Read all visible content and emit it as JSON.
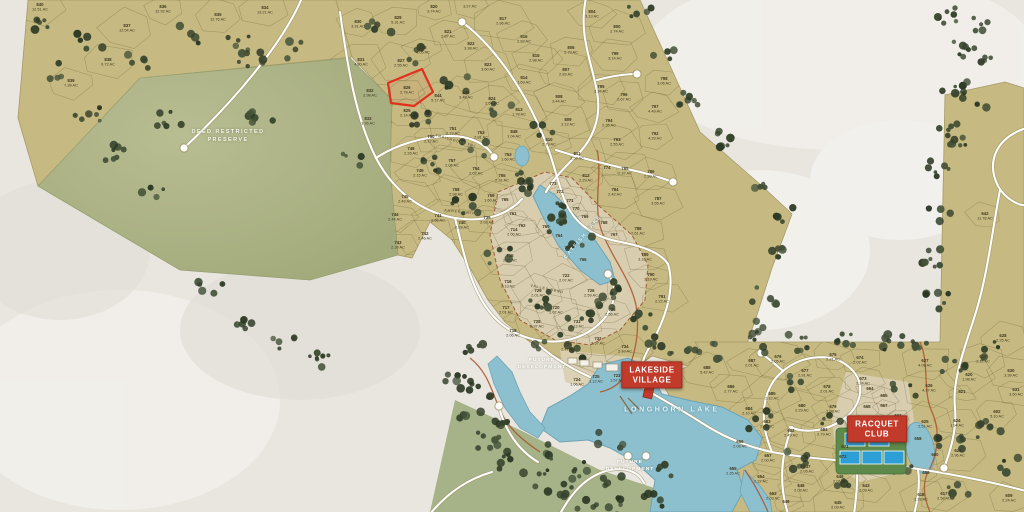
{
  "title": "Lakeside community plat map",
  "colors": {
    "background": "#e9e6e0",
    "land_tan": "#c6ba82",
    "preserve_green": "#a9b184",
    "village_beige": "#d9cfb1",
    "lake_blue": "#8cc0cf",
    "tree_green": "#36432c",
    "road_white": "#ffffff",
    "accent_red": "#c23a2a",
    "creek_orange": "#a8542c",
    "label_dark": "#3f381f"
  },
  "preserve_label": {
    "line1": "DEED RESTRICTED",
    "line2": "PRESERVE",
    "x": 228,
    "y": 136
  },
  "future_labels": [
    {
      "line1": "FUTURE",
      "line2": "DEVELOPMENT",
      "x": 542,
      "y": 364
    },
    {
      "line1": "FUTURE",
      "line2": "DEVELOPMENT",
      "x": 630,
      "y": 466
    }
  ],
  "lake_labels": [
    {
      "text": "LONGHORN LAKE",
      "x": 672,
      "y": 410
    },
    {
      "text": "CATFISH LAKE",
      "x": 583,
      "y": 237
    }
  ],
  "badges": [
    {
      "line1": "LAKESIDE",
      "line2": "VILLAGE",
      "x": 652,
      "y": 375
    },
    {
      "line1": "RACQUET",
      "line2": "CLUB",
      "x": 877,
      "y": 429
    }
  ],
  "road_labels": [
    {
      "text": "TRAILHOUSE TRL",
      "x": 456,
      "y": 141,
      "rot": 16
    },
    {
      "text": "AMBER DRIVE",
      "x": 461,
      "y": 212,
      "rot": 6
    },
    {
      "text": "VALLEY BEND",
      "x": 547,
      "y": 289,
      "rot": 12
    }
  ],
  "highlight": {
    "lot": "826",
    "area": "2.78 AC"
  },
  "lots": [
    [
      "840",
      "12.51 AC",
      40,
      6
    ],
    [
      "837",
      "12.54 AC",
      127,
      27
    ],
    [
      "836",
      "12.92 AC",
      163,
      8
    ],
    [
      "835",
      "12.76 AC",
      218,
      16
    ],
    [
      "834",
      "13.21 AC",
      265,
      9
    ],
    [
      "838",
      "9.72 AC",
      108,
      61
    ],
    [
      "839",
      "7.39 AC",
      71,
      82
    ],
    [
      "830",
      "3.31 AC",
      358,
      23
    ],
    [
      "829",
      "5.31 AC",
      398,
      19
    ],
    [
      "820",
      "3.74 AC",
      434,
      8
    ],
    [
      "",
      "3.27 AC",
      470,
      3
    ],
    [
      "828",
      "4.05 AC",
      423,
      49
    ],
    [
      "821",
      "2.87 AC",
      448,
      33
    ],
    [
      "817",
      "2.96 AC",
      503,
      20
    ],
    [
      "822",
      "3.38 AC",
      471,
      45
    ],
    [
      "816",
      "2.83 AC",
      524,
      38
    ],
    [
      "831",
      "4.80 AC",
      361,
      61
    ],
    [
      "827",
      "2.55 AC",
      401,
      62
    ],
    [
      "823",
      "3.60 AC",
      488,
      66
    ],
    [
      "815",
      "2.98 AC",
      536,
      57
    ],
    [
      "832",
      "2.98 AC",
      370,
      92
    ],
    [
      "826",
      "2.78 AC",
      407,
      89
    ],
    [
      "844",
      "5.17 AC",
      438,
      97
    ],
    [
      "845",
      "3.48 AC",
      466,
      94
    ],
    [
      "824",
      "2.54 AC",
      492,
      100
    ],
    [
      "814",
      "1.69 AC",
      524,
      79
    ],
    [
      "825",
      "2.14 AC",
      407,
      112
    ],
    [
      "813",
      "1.78 AC",
      519,
      111
    ],
    [
      "833",
      "3.26 AC",
      368,
      120
    ],
    [
      "804",
      "3.13 AC",
      592,
      13
    ],
    [
      "800",
      "2.74 AC",
      617,
      28
    ],
    [
      "806",
      "2.79 AC",
      571,
      49
    ],
    [
      "799",
      "3.14 AC",
      615,
      55
    ],
    [
      "807",
      "2.83 AC",
      566,
      71
    ],
    [
      "795",
      "2.34 AC",
      601,
      88
    ],
    [
      "796",
      "2.67 AC",
      624,
      96
    ],
    [
      "808",
      "3.44 AC",
      559,
      98
    ],
    [
      "809",
      "3.12 AC",
      568,
      121
    ],
    [
      "794",
      "2.35 AC",
      609,
      122
    ],
    [
      "798",
      "3.06 AC",
      664,
      80
    ],
    [
      "797",
      "4.49 AC",
      655,
      108
    ],
    [
      "748",
      "2.26 AC",
      411,
      150
    ],
    [
      "750",
      "2.12 AC",
      431,
      138
    ],
    [
      "751",
      "2.19 AC",
      453,
      130
    ],
    [
      "752",
      "2.91 AC",
      481,
      134
    ],
    [
      "848",
      "1.04 AC",
      514,
      133
    ],
    [
      "810",
      "2.79 AC",
      549,
      141
    ],
    [
      "811",
      "2.59 AC",
      577,
      155
    ],
    [
      "812",
      "2.29 AC",
      586,
      177
    ],
    [
      "753",
      "1.60 AC",
      508,
      156
    ],
    [
      "757",
      "2.06 AC",
      452,
      162
    ],
    [
      "754",
      "2.02 AC",
      476,
      170
    ],
    [
      "755",
      "2.31 AC",
      502,
      177
    ],
    [
      "749",
      "2.15 AC",
      420,
      172
    ],
    [
      "758",
      "2.98 AC",
      456,
      191
    ],
    [
      "759",
      "1.60 AC",
      491,
      197
    ],
    [
      "745",
      "2.49 AC",
      405,
      198
    ],
    [
      "744",
      "2.44 AC",
      395,
      216
    ],
    [
      "741",
      "2.58 AC",
      438,
      217
    ],
    [
      "740",
      "2.28 AC",
      462,
      224
    ],
    [
      "739",
      "2.03 AC",
      487,
      219
    ],
    [
      "742",
      "2.46 AC",
      425,
      235
    ],
    [
      "743",
      "2.39 AC",
      398,
      244
    ],
    [
      "714",
      "2.00 AC",
      514,
      231
    ],
    [
      "715",
      "2.32 AC",
      510,
      257
    ],
    [
      "716",
      "2.13 AC",
      508,
      283
    ],
    [
      "717",
      "2.01 AC",
      506,
      309
    ],
    [
      "718",
      "2.06 AC",
      513,
      332
    ],
    [
      "774",
      "",
      607,
      169
    ],
    [
      "773",
      "",
      553,
      185
    ],
    [
      "772",
      "",
      560,
      193
    ],
    [
      "771",
      "",
      570,
      202
    ],
    [
      "770",
      "",
      576,
      210
    ],
    [
      "769",
      "",
      585,
      218
    ],
    [
      "768",
      "",
      604,
      224
    ],
    [
      "767",
      "",
      614,
      236
    ],
    [
      "766",
      "",
      583,
      261
    ],
    [
      "765",
      "",
      505,
      201
    ],
    [
      "761",
      "",
      513,
      215
    ],
    [
      "762",
      "",
      522,
      227
    ],
    [
      "760",
      "",
      546,
      228
    ],
    [
      "764",
      "",
      559,
      237
    ],
    [
      "763",
      "",
      568,
      249
    ],
    [
      "793",
      "2.55 AC",
      617,
      141
    ],
    [
      "792",
      "4.29 AC",
      655,
      135
    ],
    [
      "785",
      "2.37 AC",
      625,
      170
    ],
    [
      "786",
      "2.93 AC",
      651,
      173
    ],
    [
      "784",
      "2.42 AC",
      615,
      191
    ],
    [
      "787",
      "3.55 AC",
      658,
      200
    ],
    [
      "788",
      "2.61 AC",
      638,
      230
    ],
    [
      "789",
      "3.10 AC",
      645,
      256
    ],
    [
      "790",
      "3.19 AC",
      651,
      276
    ],
    [
      "791",
      "2.22 AC",
      662,
      298
    ],
    [
      "722",
      "2.07 AC",
      566,
      277
    ],
    [
      "729",
      "2.01 AC",
      538,
      292
    ],
    [
      "726",
      "2.59 AC",
      591,
      292
    ],
    [
      "720",
      "2.02 AC",
      556,
      309
    ],
    [
      "735",
      "2.56 AC",
      612,
      311
    ],
    [
      "728",
      "2.37 AC",
      537,
      323
    ],
    [
      "731",
      "2.12 AC",
      577,
      323
    ],
    [
      "732",
      "2.57 AC",
      598,
      340
    ],
    [
      "727",
      "2.47 AC",
      568,
      346
    ],
    [
      "734",
      "2.10 AC",
      625,
      348
    ],
    [
      "733",
      "2.06 AC",
      628,
      365
    ],
    [
      "724",
      "1.06 AC",
      577,
      381
    ],
    [
      "725",
      "1.12 AC",
      596,
      378
    ],
    [
      "723",
      "1.57 AC",
      617,
      377
    ],
    [
      "688",
      "5.42 AC",
      707,
      369
    ],
    [
      "686",
      "2.77 AC",
      731,
      388
    ],
    [
      "687",
      "2.01 AC",
      752,
      362
    ],
    [
      "676",
      "2.05 AC",
      778,
      358
    ],
    [
      "675",
      "2.21 AC",
      833,
      356
    ],
    [
      "674",
      "2.02 AC",
      860,
      359
    ],
    [
      "673",
      "2.24 AC",
      863,
      380
    ],
    [
      "677",
      "2.91 AC",
      805,
      372
    ],
    [
      "627",
      "4.08 AC",
      925,
      362
    ],
    [
      "626",
      "4.37 AC",
      929,
      387
    ],
    [
      "685",
      "2.12 AC",
      772,
      395
    ],
    [
      "680",
      "2.29 AC",
      802,
      407
    ],
    [
      "678",
      "2.01 AC",
      827,
      388
    ],
    [
      "679",
      "2.08 AC",
      833,
      408
    ],
    [
      "684",
      "2.10 AC",
      749,
      410
    ],
    [
      "683",
      "2.02 AC",
      767,
      423
    ],
    [
      "682",
      "2.49 AC",
      791,
      432
    ],
    [
      "681",
      "2.79 AC",
      824,
      431
    ],
    [
      "625",
      "2.51 AC",
      925,
      423
    ],
    [
      "624",
      "1.94 AC",
      957,
      422
    ],
    [
      "602",
      "5.10 AC",
      997,
      413
    ],
    [
      "623",
      "2.96 AC",
      958,
      452
    ],
    [
      "656",
      "2.08 AC",
      740,
      443
    ],
    [
      "657",
      "2.00 AC",
      768,
      457
    ],
    [
      "655",
      "2.35 AC",
      733,
      470
    ],
    [
      "654",
      "2.27 AC",
      761,
      478
    ],
    [
      "653",
      "2.03 AC",
      773,
      495
    ],
    [
      "647",
      "2.05 AC",
      807,
      468
    ],
    [
      "648",
      "2.03 AC",
      801,
      487
    ],
    [
      "646",
      "2.01 AC",
      840,
      478
    ],
    [
      "643",
      "2.09 AC",
      866,
      487
    ],
    [
      "645",
      "2.09 AC",
      838,
      504
    ],
    [
      "649",
      "",
      786,
      503
    ],
    [
      "618",
      "2.28 AC",
      921,
      496
    ],
    [
      "617",
      "2.58 AC",
      944,
      495
    ],
    [
      "609",
      "2.24 AC",
      1009,
      497
    ],
    [
      "664",
      "",
      870,
      390
    ],
    [
      "665",
      "",
      884,
      397
    ],
    [
      "667",
      "",
      884,
      407
    ],
    [
      "668",
      "",
      867,
      408
    ],
    [
      "663",
      "",
      898,
      417
    ],
    [
      "670",
      "",
      853,
      433
    ],
    [
      "671",
      "",
      845,
      448
    ],
    [
      "672",
      "",
      843,
      458
    ],
    [
      "660",
      "",
      935,
      456
    ],
    [
      "659",
      "",
      926,
      474
    ],
    [
      "658",
      "",
      918,
      440
    ],
    [
      "642",
      "11.78 AC",
      985,
      215
    ],
    [
      "628",
      "2.25 AC",
      1003,
      337
    ],
    [
      "619",
      "2.11 AC",
      983,
      358
    ],
    [
      "620",
      "1.98 AC",
      969,
      376
    ],
    [
      "621",
      "",
      962,
      393
    ],
    [
      "630",
      "3.39 AC",
      1011,
      372
    ],
    [
      "631",
      "3.50 AC",
      1016,
      391
    ]
  ]
}
